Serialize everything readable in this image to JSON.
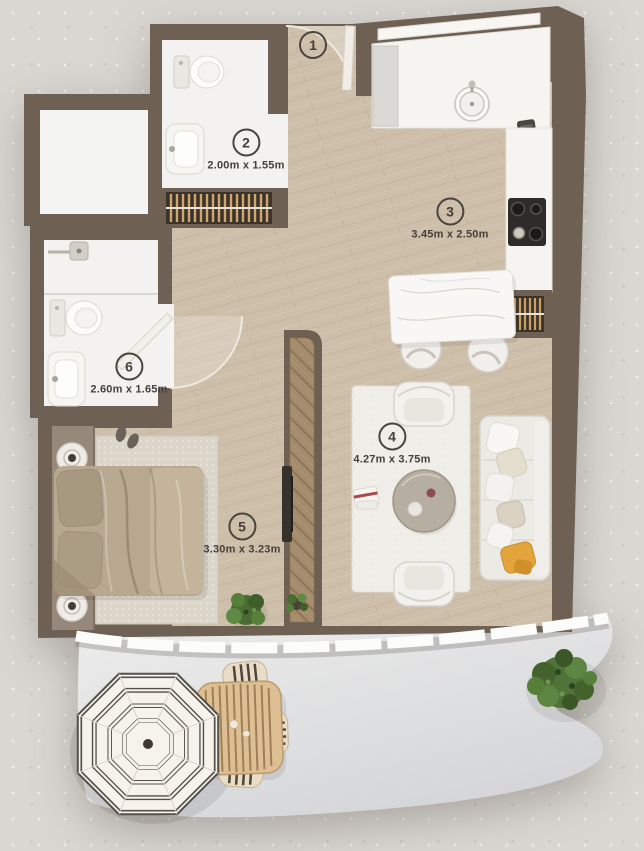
{
  "rooms": [
    {
      "number": "1",
      "dimensions": ""
    },
    {
      "number": "2",
      "dimensions": "2.00m x 1.55m"
    },
    {
      "number": "3",
      "dimensions": "3.45m x 2.50m"
    },
    {
      "number": "4",
      "dimensions": "4.27m x 3.75m"
    },
    {
      "number": "5",
      "dimensions": "3.30m x 3.23m"
    },
    {
      "number": "6",
      "dimensions": "2.60m x 1.65m"
    }
  ],
  "colors": {
    "background": "#dad7d3",
    "wall": "#6e6154",
    "wood_floor": "#cdbfa9",
    "white_floor": "#f3f2f0",
    "balcony_floor": "#e7e7e6",
    "label_text": "#453f39",
    "accent_pillow_yellow": "#e4a43c",
    "plant_green": "#4e7338",
    "outdoor_wood": "#debf93",
    "wardrobe_wood": "#a48c6c"
  }
}
